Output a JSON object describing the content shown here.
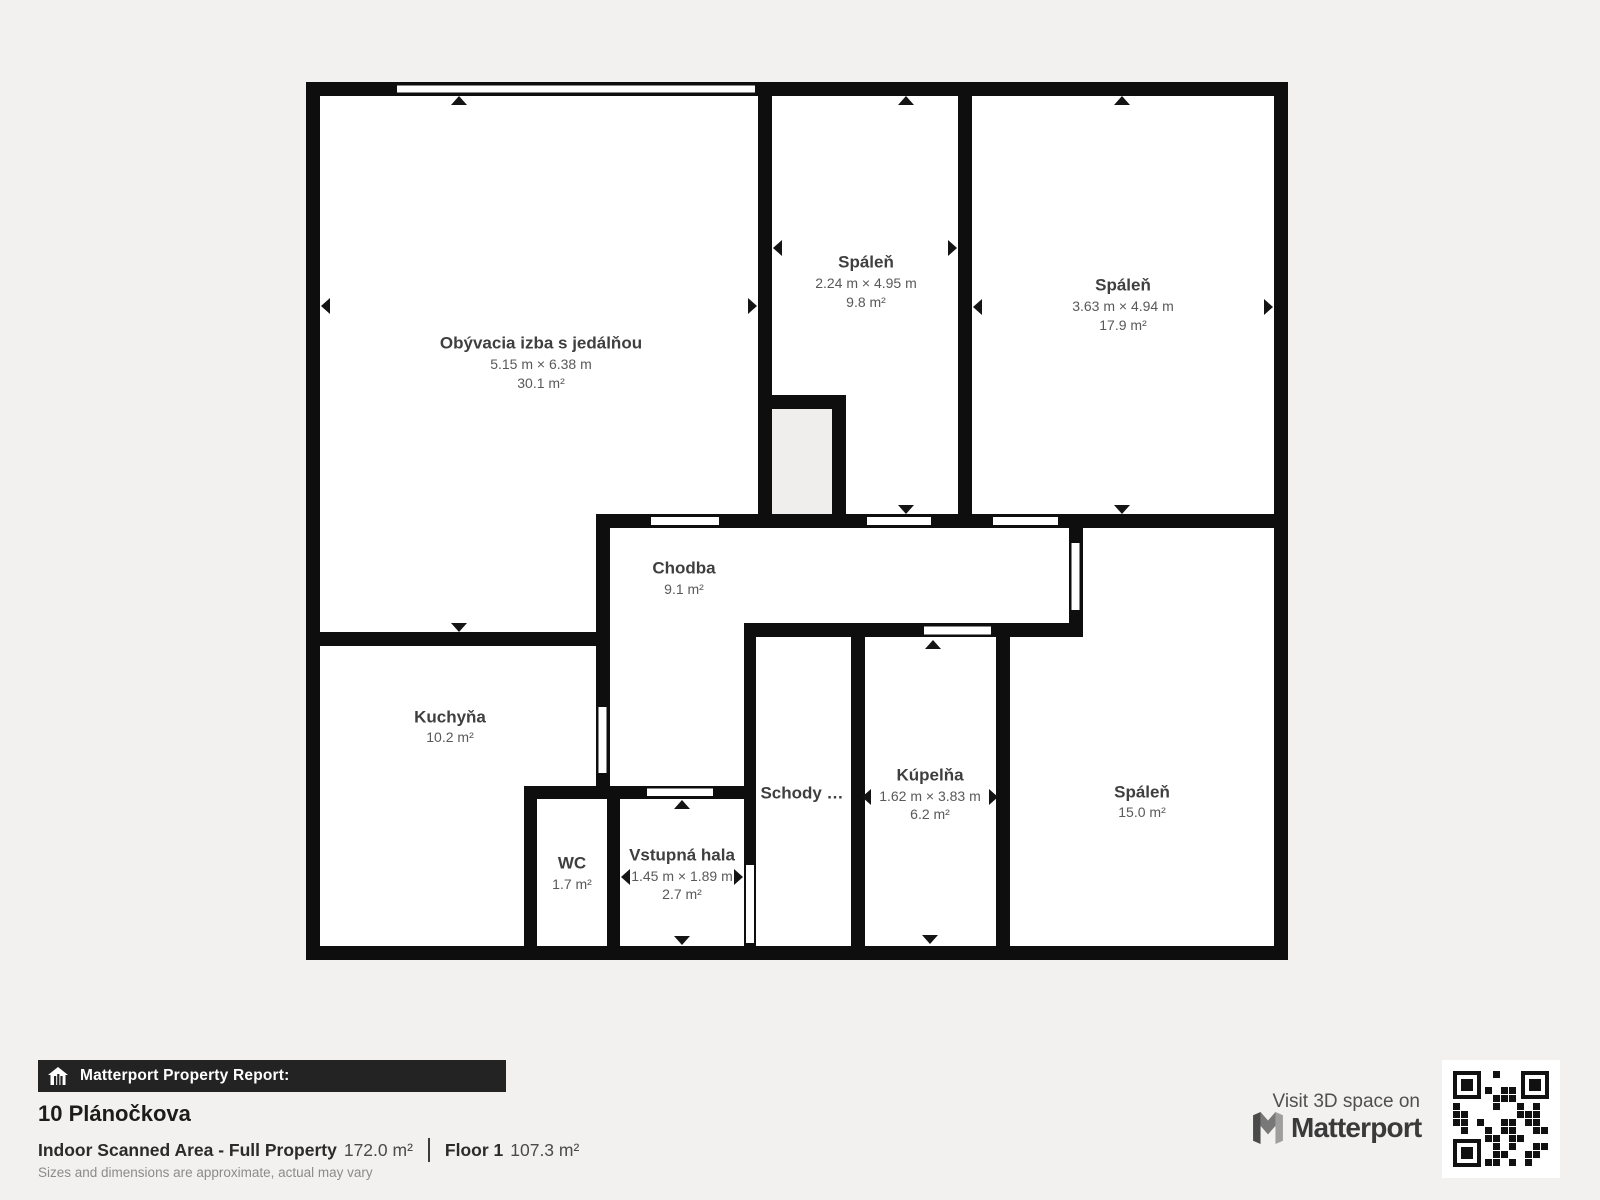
{
  "floorplan": {
    "rooms": [
      {
        "name": "Obývacia izba s jedálňou",
        "dims": "5.15 m × 6.38 m",
        "area": "30.1 m²"
      },
      {
        "name": "Spáleň",
        "dims": "2.24 m × 4.95 m",
        "area": "9.8 m²"
      },
      {
        "name": "Spáleň",
        "dims": "3.63 m × 4.94 m",
        "area": "17.9 m²"
      },
      {
        "name": "Chodba",
        "area": "9.1 m²"
      },
      {
        "name": "Kuchyňa",
        "area": "10.2 m²"
      },
      {
        "name": "WC",
        "area": "1.7 m²"
      },
      {
        "name": "Vstupná hala",
        "dims": "1.45 m × 1.89 m",
        "area": "2.7 m²"
      },
      {
        "name": "Schody …"
      },
      {
        "name": "Kúpelňa",
        "dims": "1.62 m × 3.83 m",
        "area": "6.2 m²"
      },
      {
        "name": "Spáleň",
        "area": "15.0 m²"
      }
    ]
  },
  "report": {
    "bar_label": "Matterport Property Report:",
    "address": "10 Plánočkova",
    "area_label": "Indoor Scanned Area - Full Property",
    "area_value": "172.0 m²",
    "floor_label": "Floor 1",
    "floor_value": "107.3 m²",
    "disclaimer": "Sizes and dimensions are approximate, actual may vary"
  },
  "promo": {
    "visit_label": "Visit 3D space on",
    "brand": "Matterport"
  },
  "icons": {
    "report_bar_icon": "house-icon",
    "brand_icon": "matterport-m-icon",
    "qr": "qr-code"
  },
  "colors": {
    "page_bg": "#f2f1ef",
    "wall": "#0e0e0e",
    "room_fill": "#ffffff",
    "closet_fill": "#efeeec",
    "bar_bg": "#232323",
    "name_text": "#3f3f3f",
    "sub_text": "#595959"
  }
}
